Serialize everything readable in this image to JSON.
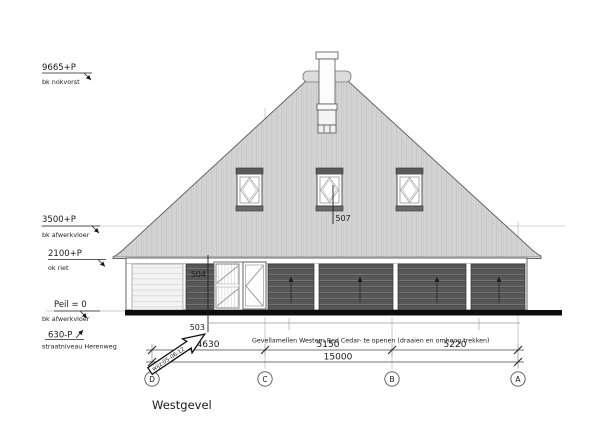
{
  "drawing": {
    "title": "Westgevel",
    "levels": [
      {
        "value": "9665+P",
        "desc": "bk nokvorst"
      },
      {
        "value": "3500+P",
        "desc": "bk afwerkvloer"
      },
      {
        "value": "2100+P",
        "desc": "ok riet"
      },
      {
        "value": "Peil = 0",
        "desc": "bk afwerkvloer"
      },
      {
        "value": "630-P",
        "desc": "straatniveau Herenweg"
      }
    ],
    "part_labels": {
      "roof_window": "507",
      "cladding_upper": "504",
      "plinth": "503"
    },
    "note": "Gevellamellen Western Red Cedar- te openen  (draaien en omhoog trekken)",
    "revision": "wijz:05-06-12",
    "dimensions": {
      "segment_dc": "4630",
      "segment_cb": "5150",
      "segment_ba": "5220",
      "total": "15000"
    },
    "grid": [
      "D",
      "C",
      "B",
      "A"
    ],
    "colors": {
      "thatch": "#d4d4d4",
      "cedar_slats": "#575757",
      "ground": "#0d0d0d"
    }
  }
}
